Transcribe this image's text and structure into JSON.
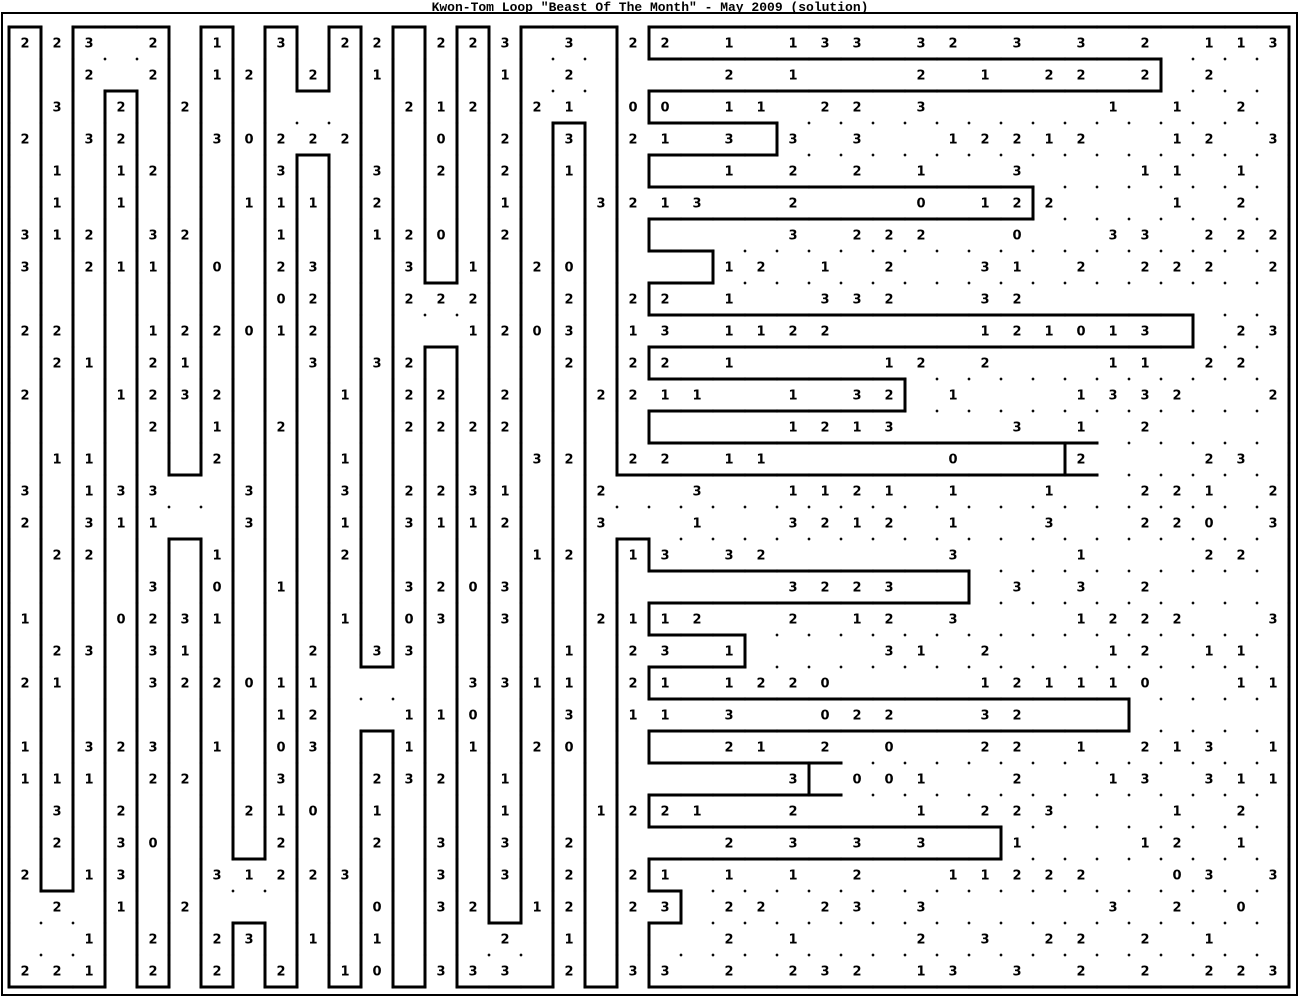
{
  "title": "Kwon-Tom Loop \"Beast Of The Month\" - May 2009 (solution)",
  "colors": {
    "ink": "#000000",
    "background": "#ffffff"
  },
  "grid": {
    "rows": 30,
    "cols": 40,
    "cell_px": 32,
    "origin_x": 9,
    "origin_y": 27,
    "frame": {
      "x": 2,
      "y": 13,
      "w": 1295,
      "h": 982
    }
  },
  "cells": [
    "223.2.1.3.22.223.3.22.1.133.32.3.3.2.113",
    "..2.2.12.2.1...1.2....2.1...2.1.22.2.2..",
    ".3.2.2......212.21.00.11.22.3.....1.1.2.",
    "2.32..30222..0.2.3.21.3.3.3..12212..12.3",
    ".1.12...3..3.2.2.1....1.2.2.1..3...11.1.",
    ".1.1...111.2...1..3213..2...0.122...1.2.",
    "312.32..1..120.2........3.222..0..33.222",
    "3.211.0.23..3.1.20....12.1.2..31.2.222.2",
    "........02..222..2.22.1..332..32........",
    "22..122012....1203.13.1122....121013..23",
    ".21.21...3.32....2.22.1....12.2...11.22.",
    "2..1232...1.22.2..2211..1.32.1...1332..2",
    "....2.1.2...2222........1213...3.1.2....",
    ".11...2...1.....32.22.11.....0...2...23.",
    "3.133..3..3.2231..2..3..1121.1..1..221.2",
    "2.311..3..1.3112..3..1..3212.1..3..220.3",
    ".22...1...2.....12.13.32.....3...1...22.",
    "....3.0.1...3203........3223...3.3.2....",
    "1..0231...1.03.3..2112..2.12.3...1222..3",
    ".23.31...2.33....1.23.1....31.2...12.11.",
    "21..322011....3311.21.1220....121110..11",
    "........12..110..3.11.3..022..32........",
    "1.323.1.03..1.1.20....21.2.0..22.1.213.1",
    "111.22..3..232.1........3.001..2..13.311",
    ".3.2...210.1...1..1221..2...1.223...1.2.",
    ".2.30...2..2.3.3.2....2.3.3.3..1...12.1.",
    "2.13..31223..3.3.2.21.1.1.2..11222..03.3",
    ".2.1.2.....0.32.12.23.22.23.3.....3.2.0.",
    "..1.2.23.1.1...2.1....2.1...2.3.22.2.1..",
    "221.2.2.2.10.333.2.33.2.232.13.3.2.2.223"
  ],
  "loop": {
    "h": [
      "1011101010101010111011111111111111111111",
      "0000000000000000000011111111111111110000",
      "0001000001000000000011111111111111110000",
      "0000000000000000010011110000000000000000",
      "0000000001000000000011110000000000000000",
      "0000000000000000000011111111111100000000",
      "0000000000000000000011111111111100000000",
      "0000000000000000000011000000000000000000",
      "0000000000000100000011000000000000000000",
      "0000000000000000000011111111111111111000",
      "0000000000000100000011111111111111111000",
      "0000000000000000000011111111000000000000",
      "0000000000000000000011111111000000000000",
      "0000000000000000000011111111111111000000",
      "0000010000000000000111111111111111000000",
      "0000000000000000000000000000000000000000",
      "0000010000000000000100000000000000000000",
      "0000000000000000000011111111110000000000",
      "0000000000000000000011111111110000000000",
      "0000000000000000000011100000000000000000",
      "0000000000010000000011100000000000000000",
      "0000000000000000000011111111111111100000",
      "0000000000010000000011111111111111100000",
      "0000000000000000000011111100000000000000",
      "0000000000000000000011111100000000000000",
      "0000000000000000000011111111111000000000",
      "0000000100000000000011111111111000000000",
      "0100000000000000000010000000000000000000",
      "0000000100000001000010000000000000000000",
      "0000000000000000000000000000000000000000",
      "1110101010101011101011111111111111111111"
    ],
    "v": [
      "11100111111111111001100000000000000000001",
      "11100111111111111001000000000000000010001",
      "11111111100111111001100000000000000000001",
      "11111111100111111111000010000000000000001",
      "11111111111111111111100000000000000000001",
      "11111111111111111111000000000000100000001",
      "11111111111111111111100000000000000000001",
      "11111111111111111111001000000000000000001",
      "11111111111110011111100000000000000000001",
      "11111111111110011111000000000000000001001",
      "11111111111111111111100000000000000000001",
      "11111111111111111111000000001000000000001",
      "11111111111111111111100000000000000000001",
      "11111111111111111111000000000000010000001",
      "11111001111111111110000000000000000000001",
      "11111001111111111110000000000000000000001",
      "11111111111111111111100000000000000000001",
      "11111111111111111111000000000010000000001",
      "11111111111111111111100000000000000000001",
      "11111111111111111111000100000000000000001",
      "11111111111001111111100000000000000000001",
      "11111111111001111111000000000000000100001",
      "11111111111111111111100000000000000000001",
      "11111111111111111111000001000000000000001",
      "11111111111111111111100000000000000000001",
      "11111111111111111111000000000001000000001",
      "11111110011111111111100000000000000000001",
      "10011110011111111111010000000000000000001",
      "10011111111111100111100000000000000000001",
      "10011111111111100111100000000000000000001"
    ]
  }
}
